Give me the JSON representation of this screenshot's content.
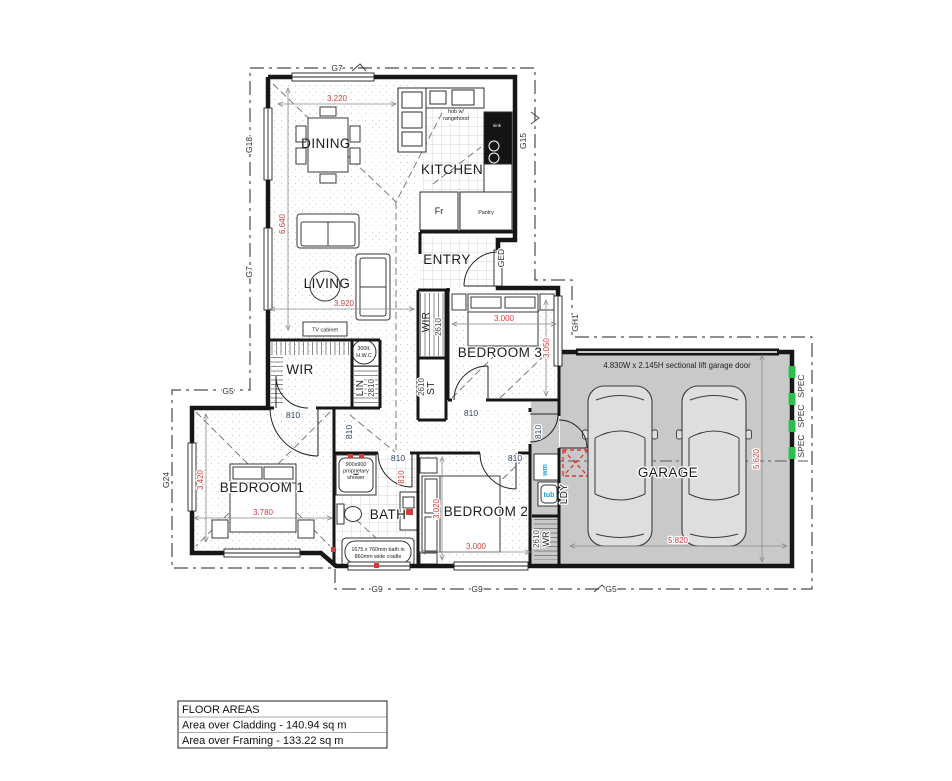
{
  "plan": {
    "rooms": {
      "dining": "DINING",
      "kitchen": "KITCHEN",
      "living": "LIVING",
      "entry": "ENTRY",
      "wir_main": "WIR",
      "wir_entry": "WIR",
      "bedroom1": "BEDROOM 1",
      "bedroom2": "BEDROOM 2",
      "bedroom3": "BEDROOM 3",
      "bath": "BATH",
      "laundry": "LDY",
      "garage": "GARAGE",
      "linen": "LIN",
      "store": "ST",
      "wardrobe": "WR"
    },
    "fixtures": {
      "tv_cabinet": "TV cabinet",
      "hwc_line1": "300lt.",
      "hwc_line2": "H.W.C",
      "fridge": "Fr",
      "pantry": "Pantry",
      "sink": "sink",
      "hob_line1": "hob w/",
      "hob_line2": "rangehood",
      "washing_machine": "wm",
      "tub": "tub",
      "shower_line1": "900x900",
      "shower_line2": "proprietary",
      "shower_line3": "shower",
      "bath_line1": "1675 x 760mm bath in",
      "bath_line2": "860mm wide cradle",
      "garage_door": "4.830W x 2.145H sectional lift garage door"
    },
    "dimensions": {
      "dining_w": "3.220",
      "dining_h": "6.640",
      "living_w": "3.920",
      "bed3_w": "3.000",
      "bed3_h": "3.050",
      "bed1_h": "3.420",
      "bed1_w": "3.780",
      "bed2_h": "3.020",
      "bed2_w": "3.000",
      "garage_w": "5.820",
      "garage_h": "5.620",
      "linen_d": "2810",
      "wir_entry_d": "2610",
      "store_d": "2610",
      "wardrobe_d": "2610"
    },
    "door_size": "810",
    "glazing": {
      "top": "G7",
      "left_upper": "G18",
      "left_mid": "G7",
      "bed1_top": "G5",
      "left_lower": "G24",
      "bottom_1": "G9",
      "bottom_2": "G9",
      "bottom_3": "G5",
      "right_upper": "G15",
      "entry_door": "GED",
      "bed3_right": "GH1",
      "spec": "SPEC"
    },
    "floor_areas": {
      "title": "FLOOR AREAS",
      "line1": "Area over Cladding - 140.94 sq m",
      "line2": "Area over Framing - 133.22 sq m"
    },
    "colors": {
      "dimension_red": "#d43c3c",
      "door_label_blue": "#2b3f66",
      "laundry_blue": "#1f9cd8",
      "glazing_green": "#2dbe4e",
      "garage_fill": "#c9c9c9"
    }
  }
}
